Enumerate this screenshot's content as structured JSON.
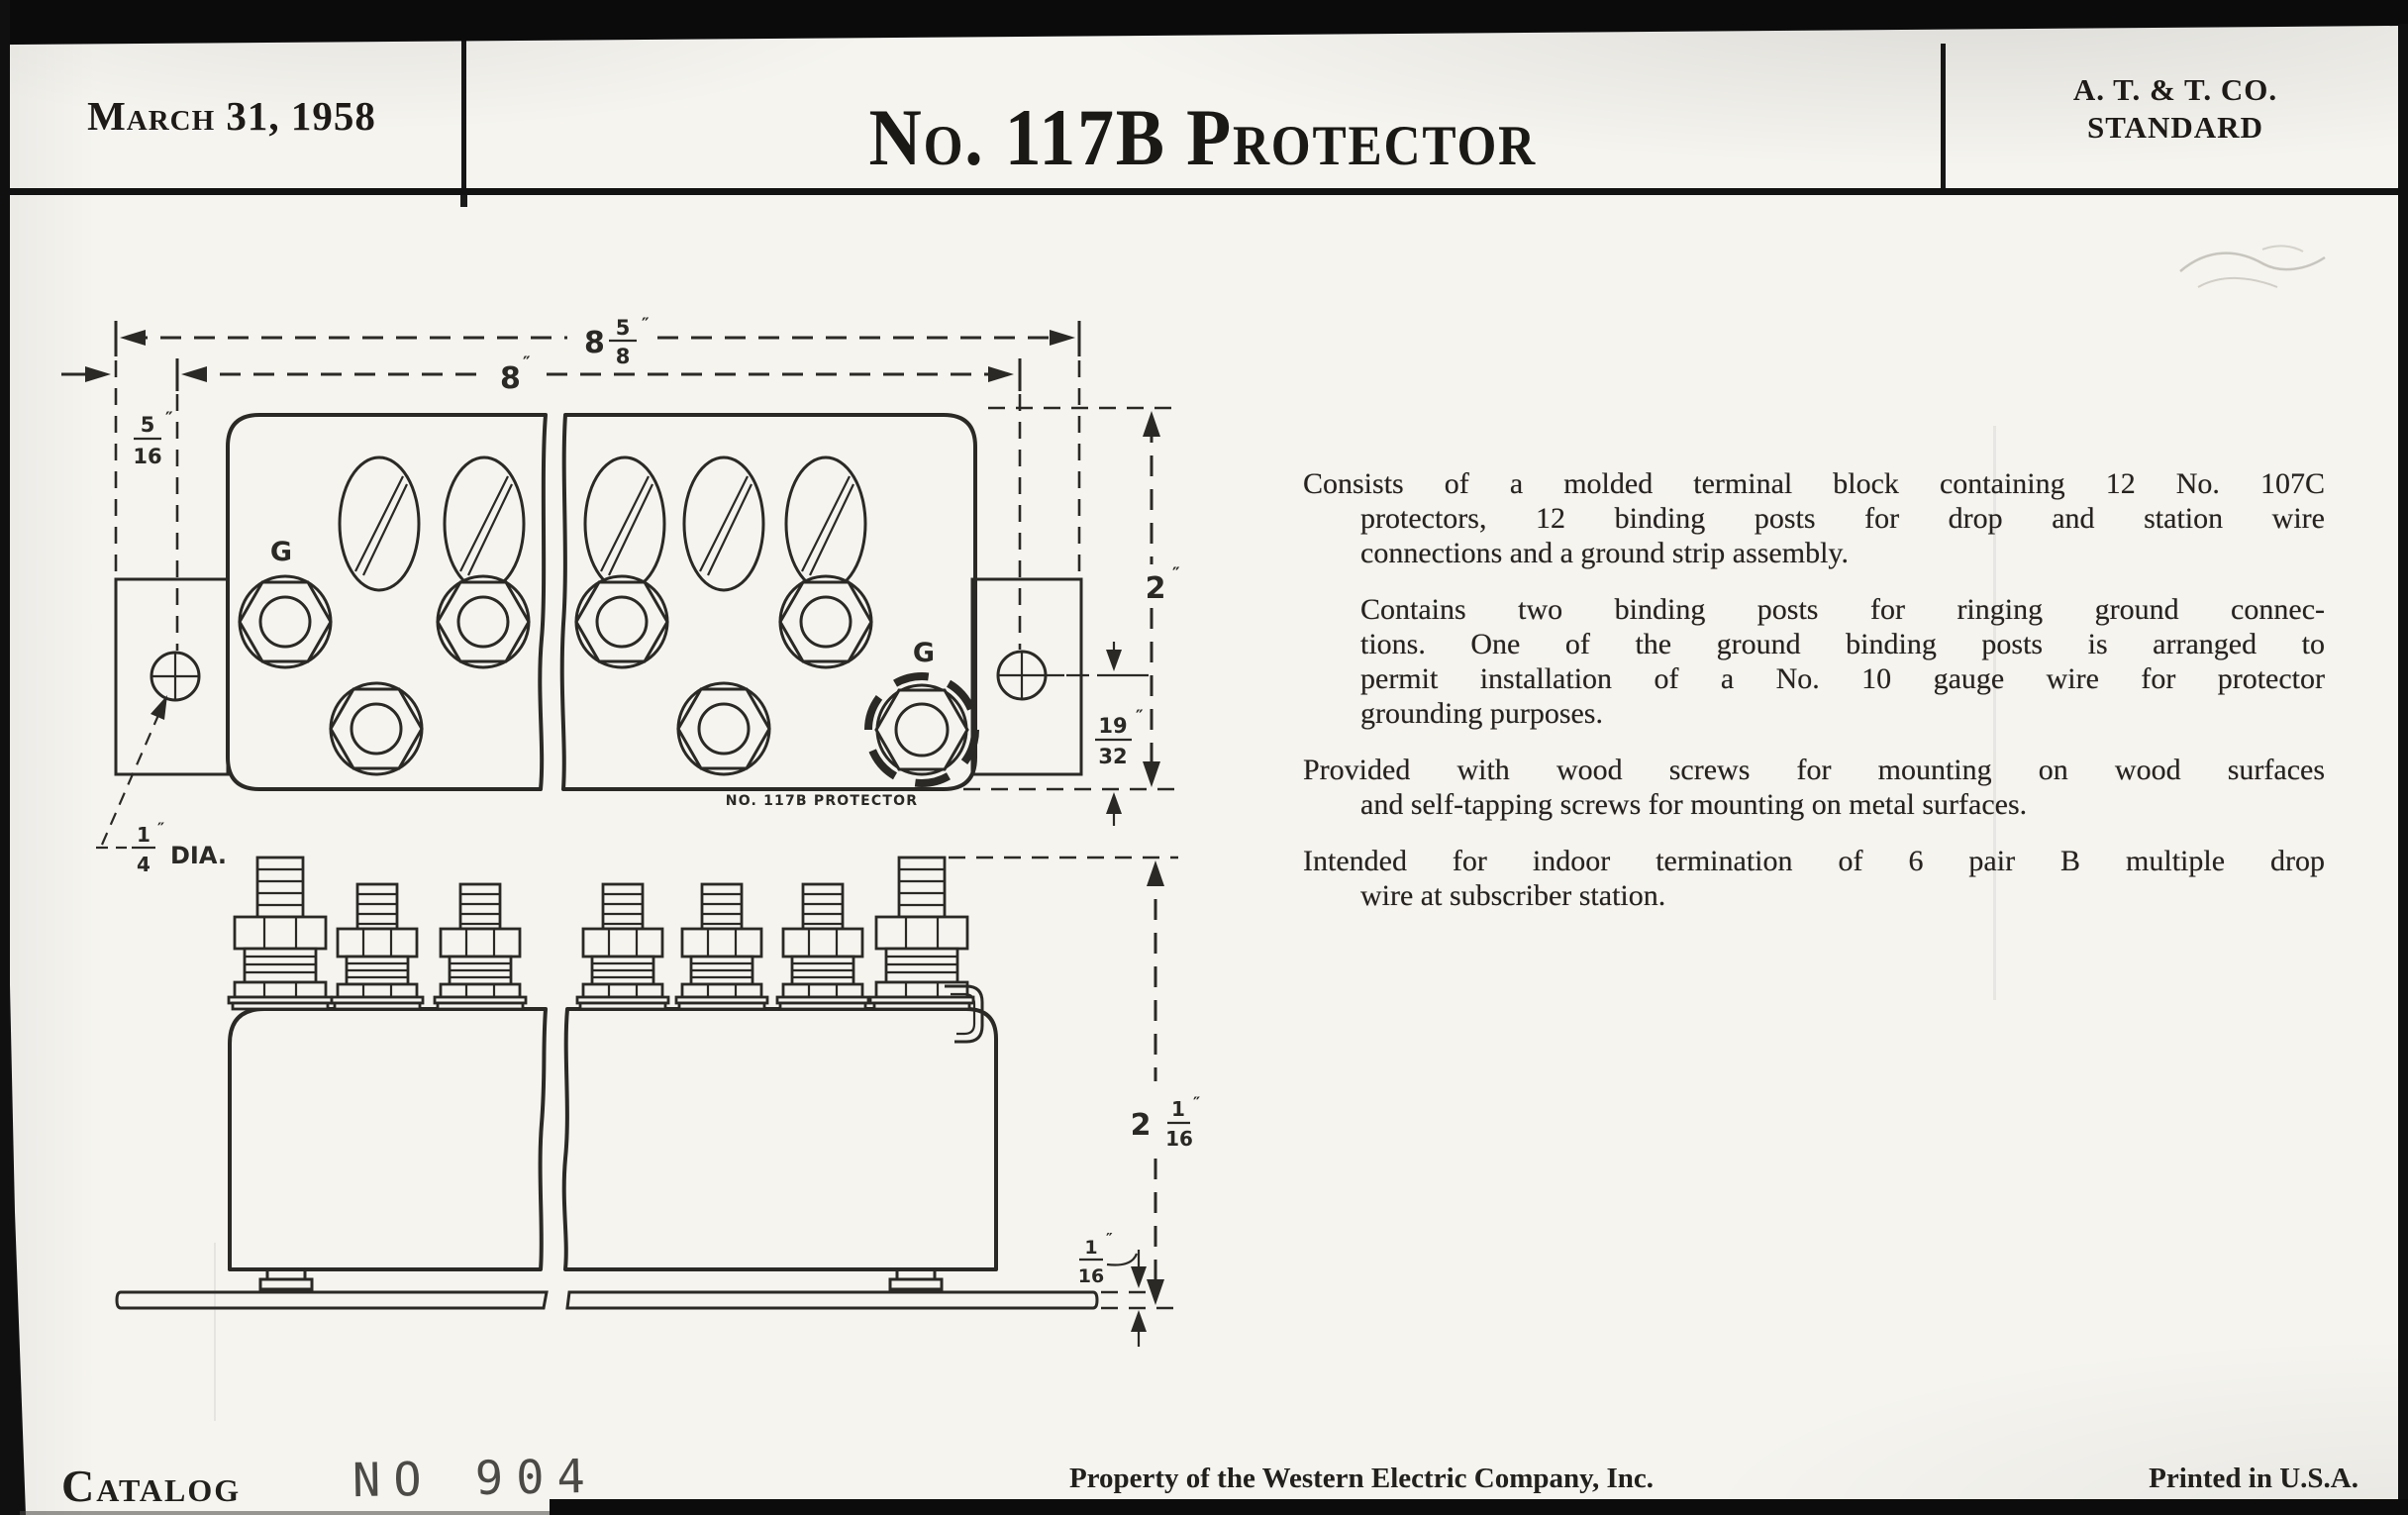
{
  "header": {
    "date": "March 31, 1958",
    "title": "No. 117B Protector",
    "org": [
      "A. T. & T. CO.",
      "STANDARD"
    ]
  },
  "body_paragraphs": [
    {
      "flush": true,
      "lines": [
        "Consists of a molded terminal block containing 12 No. 107C",
        "protectors, 12 binding posts for drop and station wire",
        "connections and a ground strip assembly."
      ]
    },
    {
      "flush": false,
      "lines": [
        "Contains two binding posts for ringing ground connec-",
        "tions. One of the ground binding posts is arranged to",
        "permit installation of a No. 10 gauge wire for protector",
        "grounding purposes."
      ]
    },
    {
      "flush": true,
      "lines": [
        "Provided with wood screws for mounting on wood surfaces",
        "and self-tapping screws for mounting on metal surfaces."
      ]
    },
    {
      "flush": true,
      "lines": [
        "Intended for indoor termination of 6 pair B multiple drop",
        "wire at subscriber station."
      ]
    }
  ],
  "footer": {
    "catalog": "Catalog",
    "stamp": "NO 904",
    "property": "Property of the Western Electric Company, Inc.",
    "printed": "Printed in U.S.A."
  },
  "drawing": {
    "ground_label": "G",
    "part_label": "NO. 117B PROTECTOR",
    "dia_suffix": "DIA.",
    "dims": {
      "overall_width": {
        "whole": "8",
        "num": "5",
        "den": "8",
        "unit": "″"
      },
      "mount_width": {
        "whole": "8",
        "unit": "″"
      },
      "edge_offset": {
        "num": "5",
        "den": "16",
        "unit": "″"
      },
      "block_height": {
        "whole": "2",
        "unit": "″"
      },
      "hole_offset": {
        "num": "19",
        "den": "32",
        "unit": "″"
      },
      "hole_dia": {
        "num": "1",
        "den": "4",
        "unit": "″"
      },
      "side_height": {
        "whole": "2",
        "num": "1",
        "den": "16",
        "unit": "″"
      },
      "plate_thickness": {
        "num": "1",
        "den": "16",
        "unit": "″"
      }
    }
  }
}
